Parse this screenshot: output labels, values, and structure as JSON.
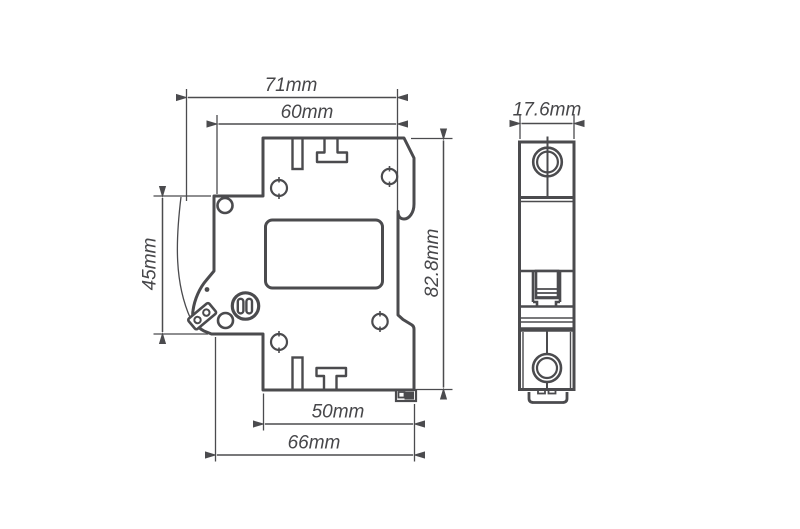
{
  "colors": {
    "line": "#4b4b4e",
    "text": "#47474a",
    "background": "#ffffff"
  },
  "side_view": {
    "dim_overall_width": "71mm",
    "dim_body_width": "60mm",
    "dim_left_height": "45mm",
    "dim_overall_height": "82.8mm",
    "dim_bottom_inner_width": "50mm",
    "dim_bottom_width": "66mm"
  },
  "front_view": {
    "dim_width": "17.6mm"
  }
}
